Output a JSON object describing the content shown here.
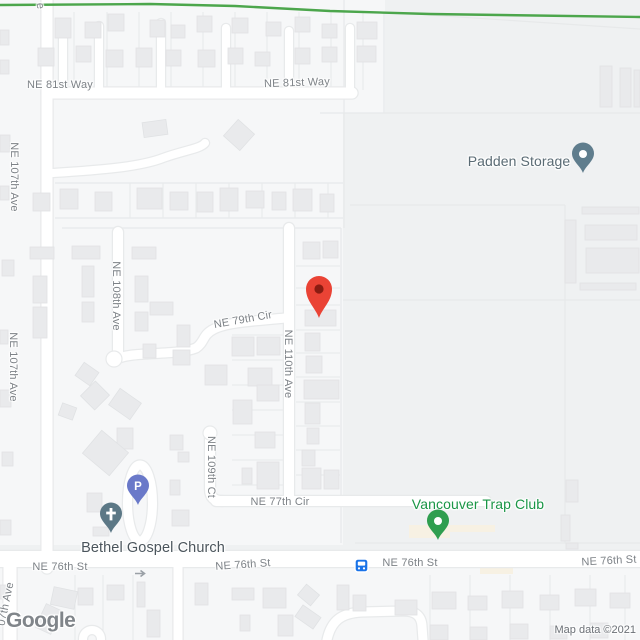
{
  "attribution": {
    "logo_text": "Google",
    "copyright_text": "Map data ©2021"
  },
  "pois": {
    "padden": {
      "name": "Padden Storage",
      "label_color": "#5a6b74",
      "label_x": 519,
      "label_y": 161,
      "label_anchor": "center",
      "pin_x": 583,
      "pin_y": 175,
      "pin_color": "#5f7d8d",
      "pin_glyph": "dot"
    },
    "trap": {
      "name": "Vancouver Trap Club",
      "label_color": "#1a9646",
      "label_x": 478,
      "label_y": 504,
      "label_anchor": "center",
      "pin_x": 438,
      "pin_y": 542,
      "pin_color": "#2f9e4f",
      "pin_glyph": "dot"
    },
    "church": {
      "name": "Bethel Gospel Church",
      "label_color": "#4b555c",
      "label_x": 153,
      "label_y": 548,
      "label_anchor": "center",
      "pin_x": 111,
      "pin_y": 535,
      "pin_color": "#5c7886",
      "pin_glyph": "cross"
    },
    "parking": {
      "name": "P",
      "label_color": "#ffffff",
      "pin_x": 138,
      "pin_y": 507,
      "pin_color": "#6a79c9",
      "pin_glyph": "P"
    }
  },
  "marker": {
    "x": 319,
    "y": 320,
    "color": "#EA4335",
    "dot_color": "#8a1c12"
  },
  "transit": {
    "bus_x": 361,
    "bus_y": 565,
    "color": "#1a73e8",
    "oneway_arrow_x": 140,
    "oneway_arrow_y": 569,
    "arrow_color": "#9aa0a6"
  },
  "street_labels": [
    [
      "NE 81st Way",
      60,
      85,
      0
    ],
    [
      "NE 81st Way",
      297,
      83,
      -2
    ],
    [
      "NE 107th Ave",
      14,
      177,
      90
    ],
    [
      "NE 107th Ave",
      13,
      367,
      90
    ],
    [
      "NE 108th Ave",
      116,
      296,
      90
    ],
    [
      "NE 110th Ave",
      288,
      364,
      90
    ],
    [
      "NE 109th Ct",
      211,
      467,
      90
    ],
    [
      "NE 79th Cir",
      243,
      320,
      -10
    ],
    [
      "NE 77th Cir",
      280,
      502,
      0
    ],
    [
      "NE 76th St",
      60,
      567,
      0
    ],
    [
      "NE 76th St",
      243,
      565,
      -4
    ],
    [
      "NE 76th St",
      410,
      563,
      0
    ],
    [
      "NE 76th St",
      609,
      561,
      -3
    ],
    [
      "e",
      40,
      6,
      85
    ],
    [
      "07th Ave",
      6,
      604,
      -78
    ]
  ],
  "map": {
    "bg": "#eff1f2",
    "parcel": "#f6f7f8",
    "road": "#ffffff",
    "casing": "#e8eaeb",
    "line": "#e7e9ea",
    "building": "#e9eaec",
    "building_edge": "#e0e2e4",
    "beige": "#f7f1e3",
    "trail": "#4ca64c",
    "patches": [
      [
        0,
        0,
        385,
        113
      ],
      [
        0,
        113,
        343,
        432
      ],
      [
        0,
        568,
        640,
        72
      ]
    ],
    "trail_points": "0,5 150,4 235,6 330,11 430,14 640,17",
    "roads": [
      [
        "ne-107th-ave",
        "M47 0 V568",
        11
      ],
      [
        "left-edge-street",
        "M10 566 V640",
        13
      ],
      [
        "ne-81st-way",
        "M47 93 H352",
        11
      ],
      [
        "stub-1",
        "M63 36 V92",
        8
      ],
      [
        "stub-2",
        "M99 26 V92",
        8
      ],
      [
        "stub-3",
        "M161 23 V92",
        8
      ],
      [
        "stub-4",
        "M226 28 V92",
        8
      ],
      [
        "stub-5",
        "M289 31 V92",
        8
      ],
      [
        "stub-6",
        "M350 28 V92",
        8
      ],
      [
        "curvy-lane",
        "M53 173 C100 170 140 167 163 158 C185 150 200 149 205 143",
        8
      ],
      [
        "ne-108th-ave",
        "M118 232 V357",
        10
      ],
      [
        "ne-110th-ave",
        "M289 228 V500",
        10
      ],
      [
        "ne-79th-cir",
        "M285 318 C255 321 228 322 214 329 C202 335 205 342 196 348 C176 356 132 351 117 359",
        9
      ],
      [
        "ne-109th-ct",
        "M210 434 V489 Q210 501 222 501",
        10
      ],
      [
        "ne-77th-cir",
        "M216 501 H486",
        10
      ],
      [
        "ne-76th-st",
        "M0 559 H640",
        16
      ],
      [
        "south-street",
        "M178 567 V640",
        9
      ],
      [
        "south-curve",
        "M327 640 C331 621 341 613 362 612 L402 611 Q421 610 422 626 L423 640",
        9
      ]
    ],
    "bulbs": [
      [
        114,
        359,
        8
      ],
      [
        210,
        433,
        7
      ]
    ],
    "oval": [
      140,
      503,
      12.5,
      38,
      9
    ],
    "roundabout": [
      92,
      639,
      9,
      8
    ],
    "boundaries": [
      "M344 0 V228",
      "M341 228 V543",
      "M384 12 V113",
      "M384 12 L640 29",
      "M320 113 H640",
      "M350 205 H565",
      "M565 205 V300",
      "M343 300 H640",
      "M565 300 V543",
      "M355 543 H640",
      "M55 183 H343",
      "M55 218 H343",
      "M62 228 H341"
    ],
    "lot_vlines": [
      [
        74,
        12,
        90
      ],
      [
        107,
        12,
        90
      ],
      [
        139,
        12,
        90
      ],
      [
        171,
        12,
        90
      ],
      [
        203,
        12,
        90
      ],
      [
        235,
        12,
        90
      ],
      [
        267,
        12,
        90
      ],
      [
        299,
        12,
        90
      ],
      [
        331,
        12,
        90
      ],
      [
        363,
        12,
        90
      ],
      [
        130,
        183,
        218
      ],
      [
        163,
        183,
        218
      ],
      [
        196,
        183,
        218
      ],
      [
        229,
        183,
        218
      ],
      [
        262,
        183,
        218
      ],
      [
        295,
        183,
        218
      ],
      [
        328,
        183,
        218
      ],
      [
        75,
        575,
        640
      ],
      [
        103,
        575,
        640
      ],
      [
        133,
        575,
        640
      ],
      [
        430,
        575,
        640
      ],
      [
        470,
        575,
        640
      ],
      [
        510,
        575,
        640
      ],
      [
        550,
        575,
        640
      ],
      [
        590,
        575,
        640
      ],
      [
        625,
        575,
        640
      ]
    ],
    "lot_hlines": [
      [
        296,
        340,
        266
      ],
      [
        296,
        340,
        288
      ],
      [
        296,
        340,
        305
      ],
      [
        296,
        340,
        330
      ],
      [
        296,
        340,
        353
      ],
      [
        296,
        340,
        377
      ],
      [
        296,
        340,
        402
      ],
      [
        296,
        340,
        426
      ],
      [
        296,
        340,
        450
      ],
      [
        296,
        340,
        475
      ],
      [
        232,
        284,
        335
      ],
      [
        232,
        284,
        360
      ],
      [
        232,
        284,
        385
      ],
      [
        232,
        284,
        410
      ],
      [
        232,
        284,
        435
      ],
      [
        232,
        284,
        460
      ],
      [
        232,
        284,
        485
      ]
    ],
    "beige_areas": [
      [
        409,
        525,
        41,
        13
      ],
      [
        450,
        525,
        45,
        7
      ],
      [
        480,
        568,
        33,
        6
      ]
    ],
    "buildings": [
      [
        55,
        18,
        16,
        20
      ],
      [
        85,
        22,
        16,
        16
      ],
      [
        108,
        14,
        16,
        17
      ],
      [
        150,
        20,
        15,
        17
      ],
      [
        171,
        25,
        14,
        13
      ],
      [
        197,
        16,
        15,
        16
      ],
      [
        232,
        18,
        16,
        15
      ],
      [
        266,
        22,
        15,
        14
      ],
      [
        295,
        17,
        15,
        15
      ],
      [
        322,
        24,
        15,
        14
      ],
      [
        357,
        22,
        20,
        17
      ],
      [
        38,
        48,
        16,
        18
      ],
      [
        76,
        46,
        15,
        16
      ],
      [
        106,
        50,
        17,
        17
      ],
      [
        136,
        48,
        16,
        19
      ],
      [
        166,
        50,
        15,
        16
      ],
      [
        198,
        50,
        17,
        17
      ],
      [
        228,
        48,
        15,
        16
      ],
      [
        255,
        52,
        15,
        14
      ],
      [
        295,
        48,
        15,
        16
      ],
      [
        322,
        47,
        15,
        15
      ],
      [
        357,
        46,
        19,
        16
      ],
      [
        0,
        30,
        9,
        15
      ],
      [
        0,
        60,
        9,
        14
      ],
      [
        600,
        66,
        12,
        41
      ],
      [
        620,
        68,
        11,
        39
      ],
      [
        634,
        70,
        6,
        37
      ],
      [
        565,
        220,
        11,
        63
      ],
      [
        582,
        207,
        57,
        7
      ],
      [
        585,
        225,
        52,
        15
      ],
      [
        586,
        248,
        53,
        25
      ],
      [
        580,
        283,
        56,
        7
      ],
      [
        143,
        121,
        24,
        15,
        -8
      ],
      [
        228,
        124,
        22,
        22,
        42
      ],
      [
        0,
        135,
        10,
        17
      ],
      [
        33,
        193,
        17,
        18
      ],
      [
        60,
        189,
        18,
        20
      ],
      [
        95,
        192,
        17,
        19
      ],
      [
        137,
        188,
        25,
        21
      ],
      [
        170,
        192,
        18,
        18
      ],
      [
        197,
        192,
        16,
        20
      ],
      [
        220,
        188,
        18,
        23
      ],
      [
        246,
        191,
        18,
        17
      ],
      [
        272,
        192,
        14,
        18
      ],
      [
        293,
        189,
        19,
        22
      ],
      [
        320,
        194,
        14,
        18
      ],
      [
        0,
        186,
        9,
        14
      ],
      [
        2,
        260,
        12,
        16
      ],
      [
        0,
        330,
        8,
        14
      ],
      [
        0,
        390,
        11,
        17
      ],
      [
        2,
        452,
        11,
        14
      ],
      [
        0,
        520,
        11,
        15
      ],
      [
        0,
        585,
        9,
        14
      ],
      [
        30,
        247,
        24,
        12
      ],
      [
        72,
        246,
        28,
        13
      ],
      [
        132,
        247,
        24,
        12
      ],
      [
        33,
        276,
        14,
        27
      ],
      [
        82,
        266,
        12,
        31
      ],
      [
        135,
        276,
        13,
        26
      ],
      [
        33,
        307,
        14,
        31
      ],
      [
        82,
        302,
        12,
        20
      ],
      [
        135,
        312,
        13,
        19
      ],
      [
        143,
        344,
        13,
        14
      ],
      [
        78,
        366,
        18,
        16,
        35
      ],
      [
        85,
        385,
        20,
        21,
        45
      ],
      [
        60,
        405,
        15,
        13,
        20
      ],
      [
        150,
        302,
        23,
        13
      ],
      [
        177,
        325,
        13,
        22
      ],
      [
        173,
        350,
        17,
        15
      ],
      [
        112,
        394,
        26,
        20,
        35
      ],
      [
        117,
        428,
        16,
        21
      ],
      [
        205,
        365,
        22,
        20
      ],
      [
        232,
        337,
        22,
        19
      ],
      [
        257,
        337,
        23,
        18
      ],
      [
        248,
        368,
        24,
        18
      ],
      [
        257,
        385,
        22,
        16
      ],
      [
        233,
        400,
        19,
        24
      ],
      [
        255,
        432,
        20,
        16
      ],
      [
        257,
        462,
        22,
        27
      ],
      [
        242,
        468,
        10,
        16
      ],
      [
        303,
        242,
        17,
        17
      ],
      [
        323,
        241,
        15,
        17
      ],
      [
        305,
        310,
        31,
        16
      ],
      [
        305,
        333,
        15,
        18
      ],
      [
        306,
        356,
        16,
        17
      ],
      [
        304,
        380,
        35,
        19
      ],
      [
        305,
        403,
        15,
        21
      ],
      [
        307,
        428,
        12,
        16
      ],
      [
        302,
        450,
        13,
        16
      ],
      [
        302,
        468,
        19,
        21
      ],
      [
        324,
        470,
        15,
        19
      ],
      [
        88,
        438,
        35,
        30,
        40
      ],
      [
        87,
        493,
        15,
        19
      ],
      [
        93,
        527,
        16,
        9
      ],
      [
        170,
        435,
        13,
        15
      ],
      [
        178,
        452,
        11,
        10
      ],
      [
        170,
        480,
        10,
        15
      ],
      [
        172,
        510,
        17,
        16
      ],
      [
        566,
        480,
        12,
        22
      ],
      [
        561,
        515,
        9,
        26
      ],
      [
        566,
        543,
        12,
        6
      ],
      [
        40,
        606,
        17,
        26,
        25
      ],
      [
        52,
        589,
        24,
        18,
        12
      ],
      [
        78,
        588,
        15,
        17
      ],
      [
        107,
        585,
        17,
        15
      ],
      [
        137,
        582,
        8,
        25
      ],
      [
        147,
        610,
        13,
        27
      ],
      [
        195,
        583,
        13,
        22
      ],
      [
        232,
        588,
        22,
        12
      ],
      [
        263,
        588,
        23,
        20
      ],
      [
        240,
        615,
        10,
        16
      ],
      [
        278,
        615,
        15,
        21
      ],
      [
        300,
        588,
        17,
        14,
        40
      ],
      [
        297,
        610,
        22,
        14,
        35
      ],
      [
        337,
        585,
        12,
        25
      ],
      [
        353,
        595,
        13,
        16
      ],
      [
        395,
        600,
        22,
        15
      ],
      [
        432,
        592,
        24,
        17
      ],
      [
        468,
        596,
        19,
        14
      ],
      [
        502,
        591,
        21,
        17
      ],
      [
        540,
        595,
        19,
        15
      ],
      [
        575,
        589,
        21,
        17
      ],
      [
        610,
        593,
        20,
        15
      ],
      [
        430,
        625,
        18,
        15
      ],
      [
        470,
        627,
        17,
        13
      ],
      [
        510,
        624,
        18,
        15
      ],
      [
        550,
        626,
        17,
        13
      ],
      [
        590,
        623,
        18,
        15
      ]
    ]
  }
}
